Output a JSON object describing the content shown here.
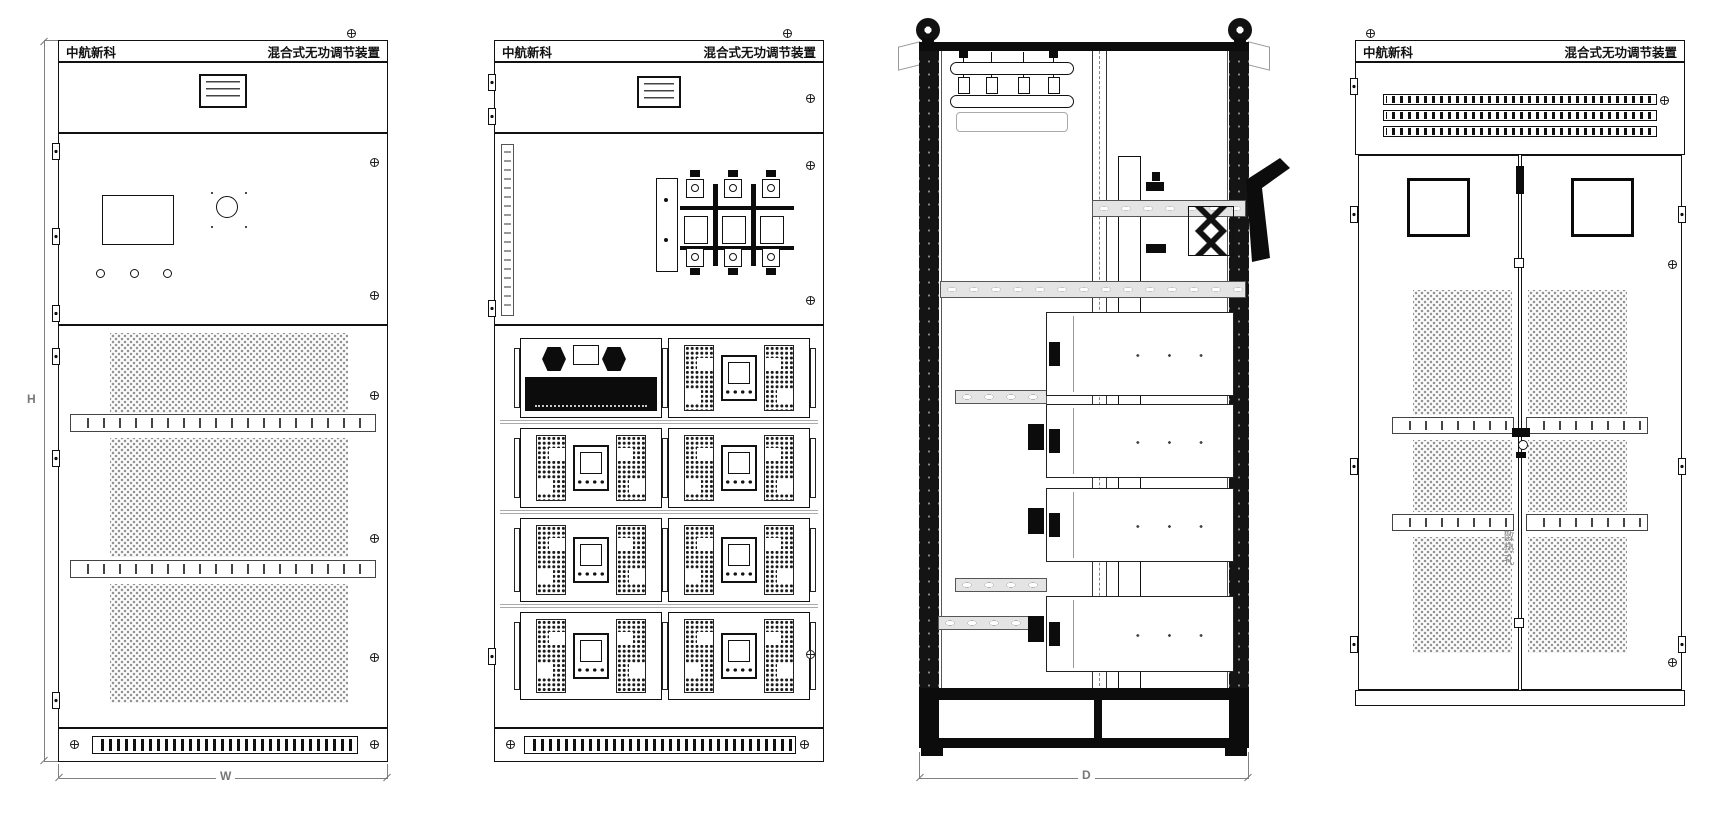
{
  "drawing": {
    "brand": "中航新科",
    "title": "混合式无功调节装置",
    "dimension_labels": {
      "height": "H",
      "width": "W",
      "depth": "D"
    },
    "annotation_label": "散热孔",
    "colors": {
      "line": "#111111",
      "dimension": "#808080",
      "mesh_dot": "#949494",
      "background": "#ffffff"
    }
  }
}
